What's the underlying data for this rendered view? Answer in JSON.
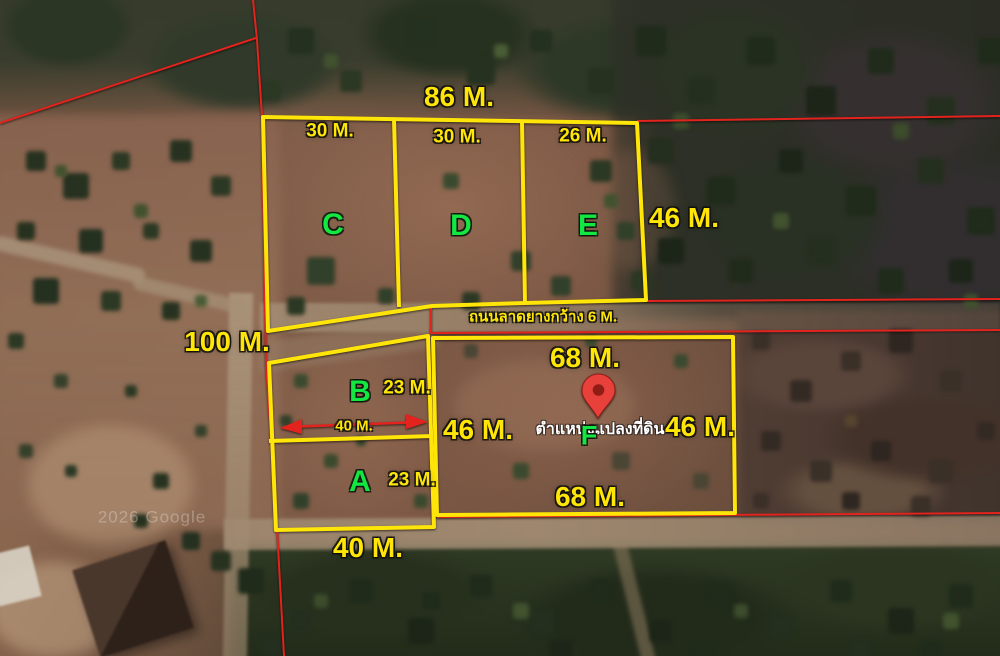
{
  "scene": {
    "watermark": "2026 Google",
    "road_label": "ถนนลาดยางกว้าง 6 M.",
    "pin_caption": "ตำแหน่งแปลงที่ดิน",
    "region_labels": {
      "top_width": "86 M.",
      "west_length": "100 M.",
      "bottom_width": "40 M."
    },
    "plots": [
      {
        "id": "C",
        "width": "30 M."
      },
      {
        "id": "D",
        "width": "30 M."
      },
      {
        "id": "E",
        "width": "26 M.",
        "depth": "46 M."
      },
      {
        "id": "B",
        "width": "23 M.",
        "frontage": "40 M."
      },
      {
        "id": "A",
        "width": "23 M."
      },
      {
        "id": "F",
        "top": "68 M.",
        "bottom": "68 M.",
        "west": "46 M.",
        "east": "46 M."
      }
    ],
    "colors": {
      "plot_outline": "#ffe608",
      "cadastral_line": "#e3231d",
      "label_yellow": "#ffe608",
      "label_green": "#12e742",
      "pin_red": "#e8413c",
      "caption_white": "#ffffff"
    }
  }
}
